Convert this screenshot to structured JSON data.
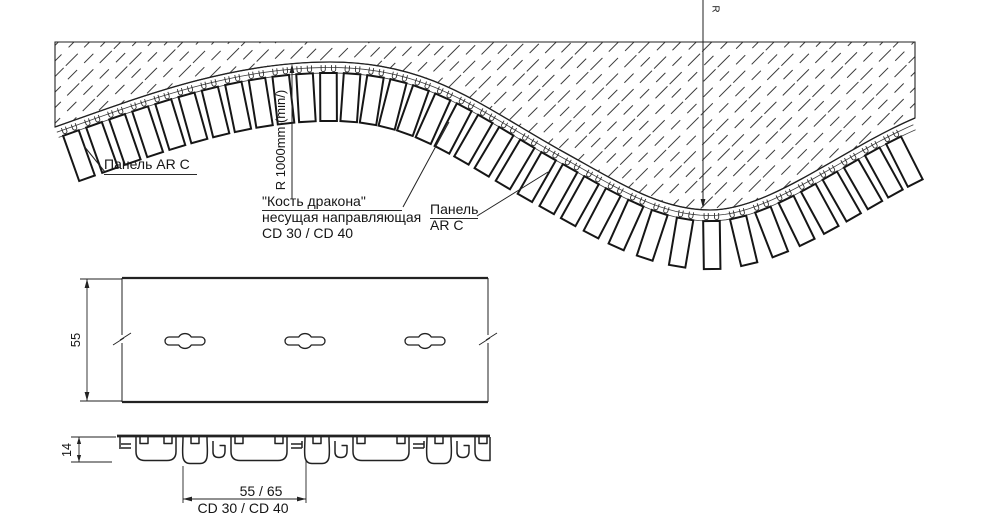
{
  "title": "Панель AR C на несущей направляющей «Кость дракона» CD 30 / CD 40 — чертёж",
  "labels": {
    "panel_left": "Панель AR C",
    "rail_line1": "\"Кость дракона\"",
    "rail_line2": "несущая направляющая",
    "rail_line3": "CD 30 / CD 40",
    "panel_right_1": "Панель",
    "panel_right_2": "AR C",
    "radius_min": "R 1000mm (min/)",
    "radius_mark": "R",
    "plan_height": "55",
    "section_depth": "14",
    "section_width": "55 / 65",
    "section_profile": "CD 30 / CD 40"
  },
  "colors": {
    "line": "#222222",
    "thin": "#3a3a3a",
    "panel_stroke": "#161616",
    "bg": "#ffffff"
  },
  "geometry": {
    "canvas": {
      "w": 1000,
      "h": 525
    },
    "curve_d": "M 55,127 C 140,97 230,62 330,62 C 430,62 480,105 560,150 C 620,183 660,210 710,210 C 770,210 840,150 915,118",
    "hatch_region_d": "M 55,42 L 915,42 L 915,118 C 840,150 770,210 710,210 C 660,210 620,183 560,150 C 480,105 430,62 330,62 C 230,62 140,97 55,127 Z",
    "rail_offsets": [
      5.5,
      11
    ],
    "panels": {
      "first": 13,
      "step": 24.5,
      "end_margin": 12,
      "top": 11,
      "bottom": 59,
      "half_width": 8.3,
      "clip_dx": 5.2,
      "clip_off": 6.3
    },
    "radius_line": {
      "x": 703,
      "y_top": 0,
      "y_tip": 208
    },
    "min_line": {
      "x": 292,
      "y_tip": 64,
      "y_bot": 199
    },
    "leaders": [
      [
        105,
        172,
        84,
        146
      ],
      [
        403,
        207,
        449,
        122
      ],
      [
        477,
        216,
        548,
        172
      ]
    ],
    "plan": {
      "x1": 122,
      "x2": 488,
      "y1": 278,
      "y2": 402,
      "slot_y": 341,
      "slot_xs": [
        185,
        305,
        425
      ],
      "dim_x": 87,
      "ext_x0": 80,
      "break_y": 339
    },
    "section": {
      "x1": 120,
      "x2": 490,
      "top": 437,
      "bottom": 463.5,
      "period_starts": [
        183,
        305,
        427
      ],
      "lead_cup": [
        136,
        176
      ],
      "dim14": {
        "x": 79,
        "ext_x0": 71,
        "y_top": 437,
        "y_bot": 462
      },
      "dim_w": {
        "y": 499,
        "xl": 183,
        "xr": 306,
        "ext_bot": 503,
        "ext_top_l": 466,
        "ext_top_r": 461
      }
    }
  }
}
